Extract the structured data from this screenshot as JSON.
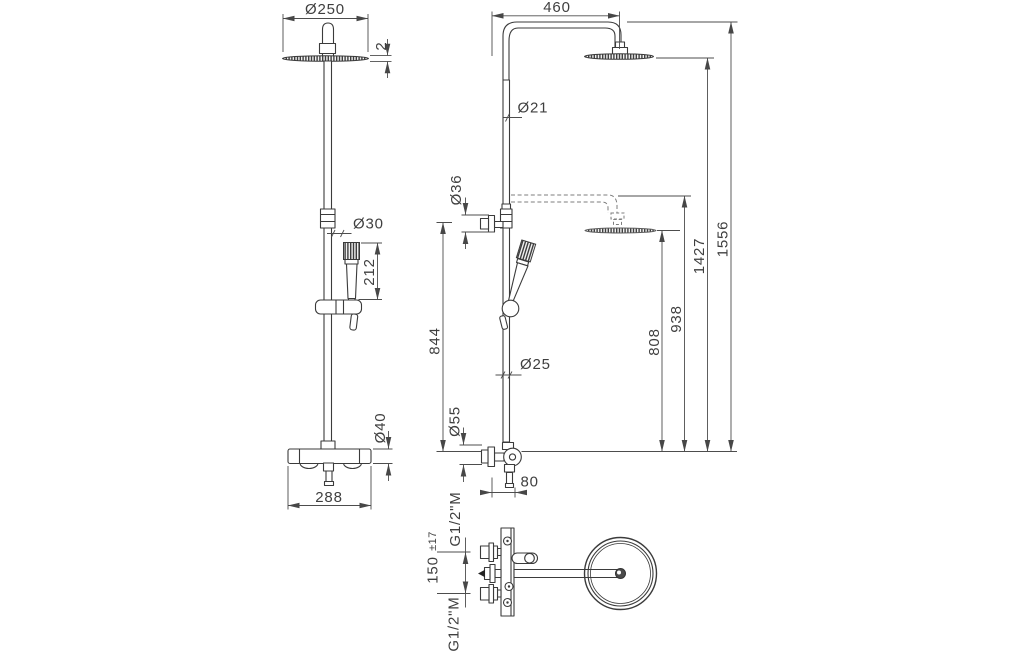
{
  "front_view": {
    "head_diameter": "Ø250",
    "head_thickness": "2",
    "handset_diameter": "Ø30",
    "handset_length": "212",
    "valve_diameter": "Ø40",
    "valve_width": "288"
  },
  "side_view": {
    "arm_projection": "460",
    "riser_upper_diameter": "Ø21",
    "diverter_diameter": "Ø36",
    "riser_height": "844",
    "riser_lower_diameter": "Ø25",
    "valve_body_diameter": "Ø55",
    "wall_offset": "80",
    "lowered_head_height": "808",
    "lowered_arm_height": "938",
    "head_height": "1427",
    "overall_height": "1556"
  },
  "top_view": {
    "upper_connection": "G1/2\"M",
    "lower_connection": "G1/2\"M",
    "connection_spacing": "150",
    "connection_tolerance": "±17"
  }
}
